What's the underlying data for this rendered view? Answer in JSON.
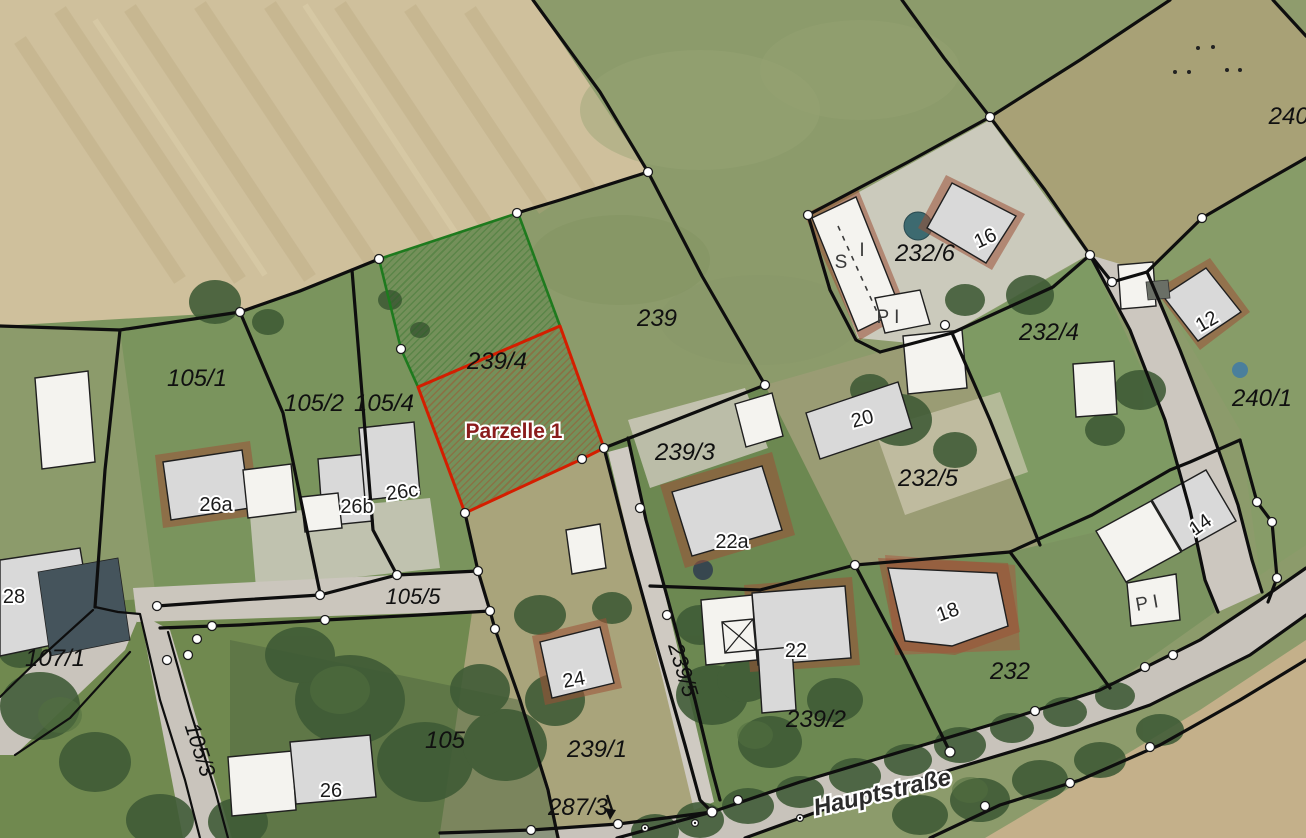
{
  "map": {
    "type": "cadastral-aerial-view",
    "highlight": {
      "label": "Parzelle 1",
      "on_parcel": "239/4"
    },
    "street": {
      "name": "Hauptstraße"
    },
    "parcels": [
      "105/1",
      "105/2",
      "105/4",
      "105/5",
      "105/3",
      "105",
      "107/1",
      "239",
      "239/4",
      "239/3",
      "239/5",
      "239/1",
      "239/2",
      "287/3",
      "232/6",
      "232/4",
      "232/5",
      "232",
      "240/",
      "240/1"
    ],
    "house_numbers": [
      "28",
      "26a",
      "26b",
      "26c",
      "26",
      "24",
      "22",
      "22a",
      "20",
      "18",
      "16",
      "14",
      "12"
    ],
    "building_annotations": [
      "S",
      "I",
      "P I",
      "P I"
    ],
    "colors": {
      "selected_parcel_outline": "#d41e00",
      "adjacent_parcel_outline": "#1e7a1e",
      "boundary_line": "#0e0e0e",
      "vertex_marker": "#ffffff",
      "parcel_label": "#101010",
      "house_number": "#1b1b1b",
      "highlight_label": "#8a1c1c"
    }
  }
}
